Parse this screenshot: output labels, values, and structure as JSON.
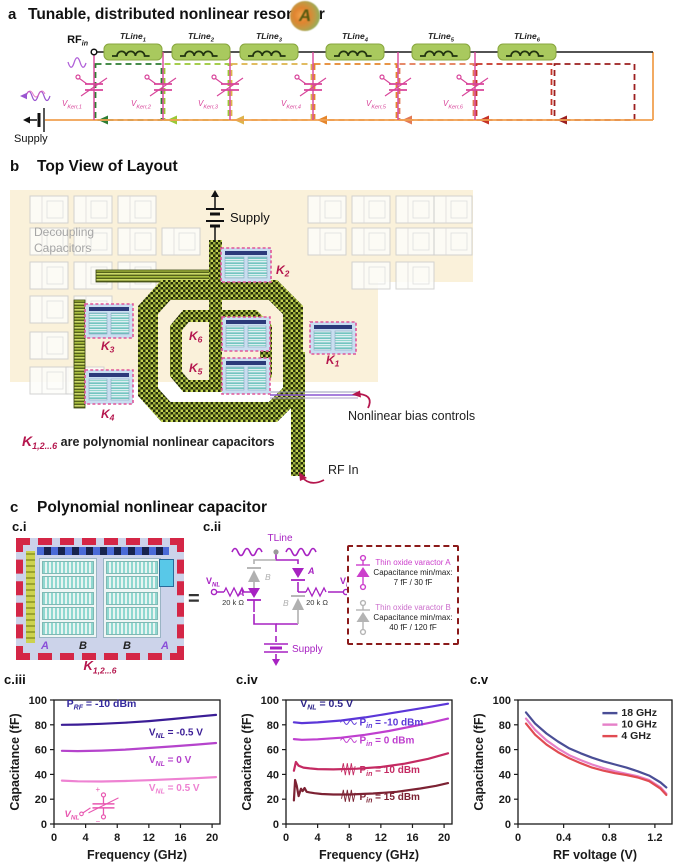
{
  "panel_a": {
    "label": "a",
    "title": "Tunable, distributed nonlinear resonator",
    "badge": "A",
    "rf_in": {
      "base": "RF",
      "sub": "in"
    },
    "supply_label": "Supply",
    "tlines": [
      {
        "base": "TLine",
        "sub": "1"
      },
      {
        "base": "TLine",
        "sub": "2"
      },
      {
        "base": "TLine",
        "sub": "3"
      },
      {
        "base": "TLine",
        "sub": "4"
      },
      {
        "base": "TLine",
        "sub": "5"
      },
      {
        "base": "TLine",
        "sub": "6"
      }
    ],
    "varactors": [
      {
        "base": "V",
        "sub": "Kerr,1"
      },
      {
        "base": "V",
        "sub": "Kerr,2"
      },
      {
        "base": "V",
        "sub": "Kerr,3"
      },
      {
        "base": "V",
        "sub": "Kerr,4"
      },
      {
        "base": "V",
        "sub": "Kerr,5"
      },
      {
        "base": "V",
        "sub": "Kerr,6"
      }
    ],
    "section_colors": [
      "#2e7d32",
      "#9ac836",
      "#ddb34c",
      "#e5862c",
      "#e37a55",
      "#c63326",
      "#9c1f1f"
    ],
    "bus_color": "#f0a050",
    "varactor_color": "#d8449a",
    "tline_fill": "#a9c95e"
  },
  "panel_b": {
    "label": "b",
    "title": "Top View of Layout",
    "decoupling_line1": "Decoupling",
    "decoupling_line2": "Capacitors",
    "supply_label": "Supply",
    "k_base": "K",
    "k_labels": [
      "2",
      "3",
      "4",
      "6",
      "5",
      "1"
    ],
    "caption": {
      "base": "K",
      "sub": "1,2...6",
      "rest": " are polynomial nonlinear capacitors"
    },
    "bias_label": "Nonlinear bias controls",
    "rf_in_label": "RF In",
    "crimson": "#b5174e"
  },
  "panel_c": {
    "label": "c",
    "title": "Polynomial nonlinear capacitor",
    "ci": {
      "label": "c.i",
      "letters": [
        "A",
        "B",
        "B",
        "A"
      ],
      "letter_colors": [
        "#8a4fd8",
        "#222222",
        "#222222",
        "#8a4fd8"
      ],
      "caption": {
        "base": "K",
        "sub": "1,2...6"
      }
    },
    "equals": "=",
    "cii": {
      "label": "c.ii",
      "tline": "TLine",
      "vnl_base": "V",
      "vnl_sub": "NL",
      "res_left": "20 k Ω",
      "res_right": "20 k Ω",
      "supply": "Supply",
      "label_a": "A",
      "label_b": "B"
    },
    "legend": {
      "entries": [
        {
          "title": "Thin oxide varactor A",
          "line2": "Capacitance min/max:",
          "line3": "7 fF / 30 fF",
          "color": "#cc3fcc"
        },
        {
          "title": "Thin oxide varactor B",
          "line2": "Capacitance min/max:",
          "line3": "40 fF / 120 fF",
          "color": "#b4b4b4"
        }
      ]
    },
    "plot_labels": [
      "c.iii",
      "c.iv",
      "c.v"
    ]
  },
  "chart_data": [
    {
      "id": "chart-ciii",
      "type": "line",
      "xlabel": "Frequency (GHz)",
      "ylabel": "Capacitance (fF)",
      "xlim": [
        0,
        21
      ],
      "ylim": [
        0,
        100
      ],
      "xticks": [
        0,
        4,
        8,
        12,
        16,
        20
      ],
      "yticks": [
        0,
        20,
        40,
        60,
        80,
        100
      ],
      "series": [
        {
          "name": "VNL = -0.5 V",
          "color": "#3b1d96",
          "x": [
            1,
            3,
            6,
            9,
            12,
            15,
            18,
            20.5
          ],
          "y": [
            80,
            80.2,
            80.8,
            81.7,
            83,
            84.7,
            86.5,
            88
          ]
        },
        {
          "name": "VNL = 0 V",
          "color": "#b544cc",
          "x": [
            1,
            3,
            6,
            9,
            12,
            15,
            18,
            20.5
          ],
          "y": [
            59,
            58.8,
            59.2,
            60,
            61.3,
            62.6,
            64,
            65.3
          ]
        },
        {
          "name": "VNL = 0.5 V",
          "color": "#ee82d2",
          "x": [
            1,
            3,
            6,
            9,
            12,
            15,
            18,
            20.5
          ],
          "y": [
            35,
            34.4,
            34.3,
            34.7,
            35.3,
            36.1,
            36.9,
            37.8
          ]
        }
      ],
      "annotations": [
        {
          "pre": "P",
          "sub": "RF",
          "post": " = -10 dBm",
          "x": 1.6,
          "y": 94.5,
          "color": "#352a9e",
          "size": 10.5
        },
        {
          "pre": "V",
          "sub": "NL",
          "post": " = -0.5 V",
          "x": 12,
          "y": 71.5,
          "color": "#3b1d96"
        },
        {
          "pre": "V",
          "sub": "NL",
          "post": " = 0 V",
          "x": 12,
          "y": 49,
          "color": "#b544cc"
        },
        {
          "pre": "V",
          "sub": "NL",
          "post": " = 0.5 V",
          "x": 12,
          "y": 26.5,
          "color": "#ee82d2"
        }
      ],
      "inset_varactor": {
        "pre": "V",
        "sub": "NL",
        "color": "#e858b0",
        "x": 5.5,
        "y": 13
      }
    },
    {
      "id": "chart-civ",
      "type": "line",
      "xlabel": "Frequency (GHz)",
      "ylabel": "Capacitance (fF)",
      "xlim": [
        0,
        21
      ],
      "ylim": [
        0,
        100
      ],
      "xticks": [
        0,
        4,
        8,
        12,
        16,
        20
      ],
      "yticks": [
        0,
        20,
        40,
        60,
        80,
        100
      ],
      "series": [
        {
          "name": "Pin = -10 dBm",
          "color": "#5b37d8",
          "x": [
            1,
            2,
            4,
            7,
            10,
            13,
            16,
            18.5,
            20.5
          ],
          "y": [
            82,
            81.4,
            81.9,
            83.5,
            86,
            89,
            92.2,
            94.8,
            97
          ]
        },
        {
          "name": "Pin = 0 dBm",
          "color": "#bf3fcf",
          "x": [
            1,
            2,
            4,
            7,
            10,
            13,
            16,
            18.5,
            20.5
          ],
          "y": [
            68.5,
            67.9,
            68.3,
            69.6,
            71.9,
            75,
            78.8,
            82,
            85
          ]
        },
        {
          "name": "Pin = 10 dBm",
          "color": "#c42a62",
          "x": [
            1,
            1.25,
            1.6,
            2.2,
            3,
            4,
            6,
            9,
            12,
            15,
            18,
            20.5
          ],
          "y": [
            43,
            50,
            47,
            45.5,
            44.8,
            44.3,
            44,
            44.6,
            46,
            48.6,
            52.6,
            57
          ]
        },
        {
          "name": "Pin = 15 dBm",
          "color": "#7c2233",
          "x": [
            1,
            1.15,
            1.35,
            1.6,
            1.9,
            2.1,
            2.35,
            2.6,
            3,
            3.6,
            4.5,
            6,
            8,
            11,
            14,
            17,
            19,
            20.5
          ],
          "y": [
            19,
            35.5,
            31,
            22.5,
            28.5,
            26.5,
            29,
            26,
            25.5,
            24.8,
            24.2,
            23.8,
            23.8,
            24.6,
            26,
            28.6,
            30.8,
            33
          ]
        }
      ],
      "annotations": [
        {
          "pre": "V",
          "sub": "NL",
          "post": " = 0.5 V",
          "x": 1.8,
          "y": 94.5,
          "color": "#2d2488",
          "size": 10.5
        },
        {
          "pre": "P",
          "sub": "in",
          "post": " = -10 dBm",
          "x": 9.3,
          "y": 79.5,
          "color": "#5b37d8",
          "wave": "small"
        },
        {
          "pre": "P",
          "sub": "in",
          "post": " = 0 dBm",
          "x": 9.3,
          "y": 65,
          "color": "#bf3fcf",
          "wave": "small"
        },
        {
          "pre": "P",
          "sub": "in",
          "post": " = 10 dBm",
          "x": 9.3,
          "y": 41,
          "color": "#c42a62",
          "wave": "large"
        },
        {
          "pre": "P",
          "sub": "in",
          "post": " = 15 dBm",
          "x": 9.3,
          "y": 19.5,
          "color": "#7c2233",
          "wave": "large"
        }
      ]
    },
    {
      "id": "chart-cv",
      "type": "line",
      "xlabel": "RF voltage (V)",
      "ylabel": "Capacitance (fF)",
      "xlim": [
        0,
        1.35
      ],
      "ylim": [
        0,
        100
      ],
      "xticks": [
        0,
        0.4,
        0.8,
        1.2
      ],
      "yticks": [
        0,
        20,
        40,
        60,
        80,
        100
      ],
      "series": [
        {
          "name": "18 GHz",
          "color": "#4a4e96",
          "x": [
            0.07,
            0.15,
            0.25,
            0.35,
            0.45,
            0.55,
            0.65,
            0.75,
            0.85,
            0.95,
            1.05,
            1.15,
            1.25,
            1.3
          ],
          "y": [
            90,
            81,
            73,
            66.5,
            61,
            57,
            53.5,
            50.5,
            48,
            45.5,
            42.5,
            39,
            33.5,
            29.5
          ]
        },
        {
          "name": "10 GHz",
          "color": "#e680c8",
          "x": [
            0.07,
            0.15,
            0.25,
            0.35,
            0.45,
            0.55,
            0.65,
            0.75,
            0.85,
            0.95,
            1.05,
            1.15,
            1.25,
            1.3
          ],
          "y": [
            85,
            76,
            67.5,
            61,
            55.5,
            51.5,
            48,
            45,
            42.5,
            40.5,
            38.5,
            35.5,
            29.5,
            24.5
          ]
        },
        {
          "name": "4 GHz",
          "color": "#e14b52",
          "x": [
            0.07,
            0.15,
            0.25,
            0.35,
            0.45,
            0.55,
            0.65,
            0.75,
            0.85,
            0.95,
            1.05,
            1.15,
            1.25,
            1.3
          ],
          "y": [
            81,
            72,
            64,
            58,
            53,
            49,
            45.5,
            43,
            41,
            39.5,
            37.5,
            34.5,
            28.5,
            23.5
          ]
        }
      ],
      "legend": {
        "x": 0.74,
        "y_start": 87,
        "dy": 11.5
      }
    }
  ]
}
